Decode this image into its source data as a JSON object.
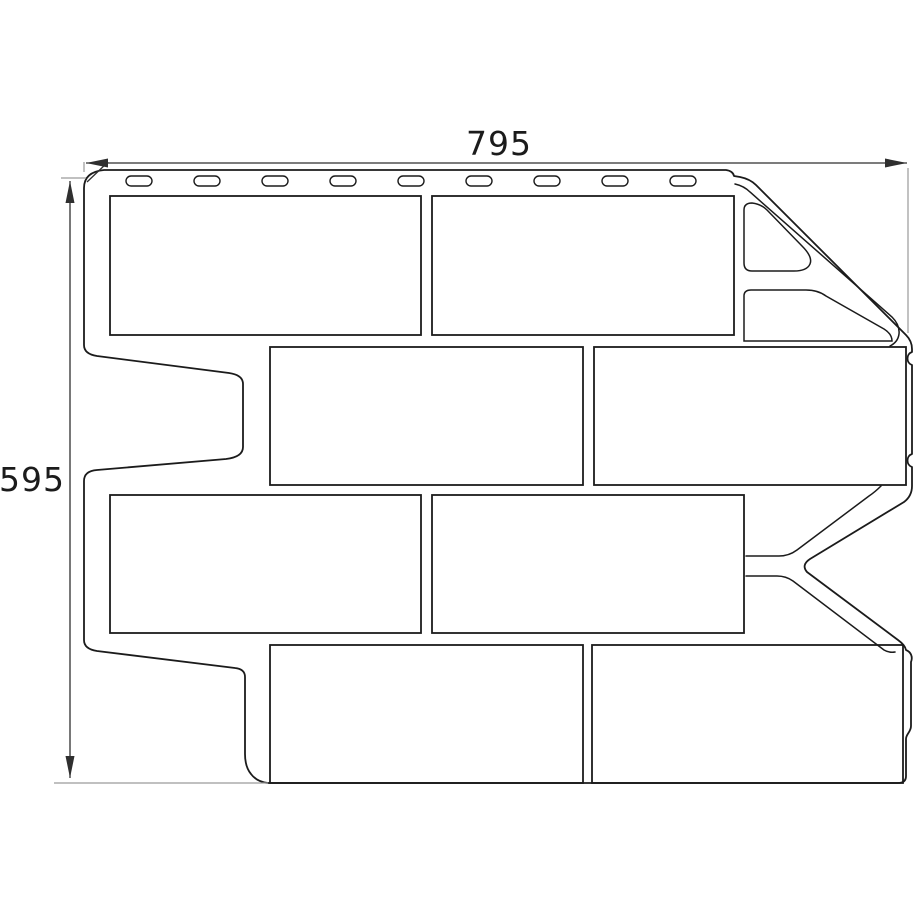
{
  "diagram": {
    "type": "technical-drawing",
    "subject": "brick-facade-panel-front-view",
    "dimensions": {
      "width_label": "795",
      "height_label": "595"
    },
    "features": {
      "nail_slots_count": 9,
      "brick_rows": 4,
      "full_bricks_per_row": 2,
      "partial_bricks_top_right": 2
    },
    "colors": {
      "background": "#ffffff",
      "line": "#1b1b1b",
      "dimension": "#2f2f2f",
      "extension": "#9a9a9a"
    }
  }
}
